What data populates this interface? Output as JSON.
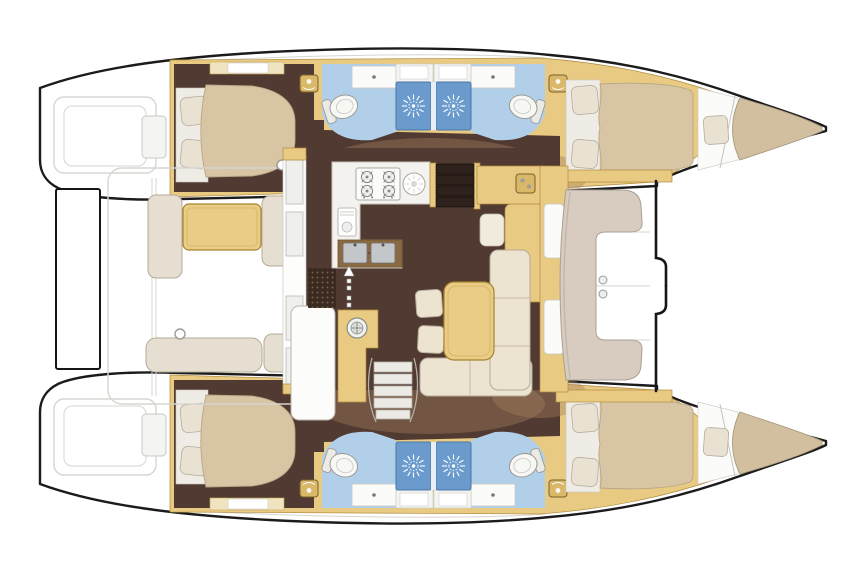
{
  "page_title": "Catamaran 4-cabin interior layout floor plan",
  "palette": {
    "white": "#ffffff",
    "white-surface": "#fbfbf9",
    "hull-outline": "#1b1b1b",
    "deck-line": "#d6d5d0",
    "wood": "#e8ca82",
    "wood-dark": "#b28c3f",
    "wood-table": "#e9cc86",
    "wood-edge": "#a8832e",
    "floor": "#503a31",
    "floor-overlay": "#a5805d",
    "bed": "#d8c5a4",
    "bed-edge": "#b8a684",
    "pillow": "#e9e2d3",
    "pillow-edge": "#b5ad9c",
    "cushion": "#e6ded0",
    "cushion-edge": "#b5ab99",
    "settee": "#ece3d1",
    "bath-floor": "#b2cfe9",
    "shower": "#6b9bcd",
    "shower-edge": "#4a76a8",
    "counter": "#f3f2ee",
    "sink-steel": "#c3c7ca",
    "grate": "#3a2a21",
    "stairs-dark": "#2f221c",
    "emblem": "#d9b86a",
    "emblem-edge": "#7c5f2c"
  },
  "vessel": {
    "layout": "catamaran-floor-plan",
    "hull_top": {
      "aft_cabin": "double berth cabin",
      "aft_head": "bathroom with toilet, vanity and shower",
      "forward_head": "bathroom with toilet, vanity and shower",
      "forward_cabin": "double berth cabin",
      "bow": "bow seat pad",
      "stern": "transom swim steps"
    },
    "hull_bottom": {
      "aft_cabin": "double berth cabin",
      "aft_head": "bathroom with toilet, vanity and shower",
      "forward_head": "bathroom with toilet, vanity and shower",
      "forward_cabin": "double berth cabin",
      "bow": "bow seat pad",
      "stern": "transom swim steps"
    },
    "bridgedeck": {
      "galley": "U-shaped galley with stove, round sink, double sink and appliance",
      "nav_station": "chart table with seat",
      "salon": "L-shaped settee with table and loose cushions",
      "aft_cockpit": "cockpit with table and bench seats",
      "forward_cockpit": "C-shaped forward seat",
      "foredeck": "open foredeck",
      "aft_platform": "aft crossbeam platform"
    }
  },
  "icons": [
    "shower-rose-icon",
    "toilet-icon",
    "vanity-sink-icon",
    "stove-burner-icon",
    "round-sink-icon",
    "double-sink-icon",
    "appliance-icon",
    "washing-machine-icon",
    "companionway-up-arrow-icon",
    "companionway-down-arrow-icon",
    "hatch-emblem-icon",
    "stairs-icon"
  ]
}
